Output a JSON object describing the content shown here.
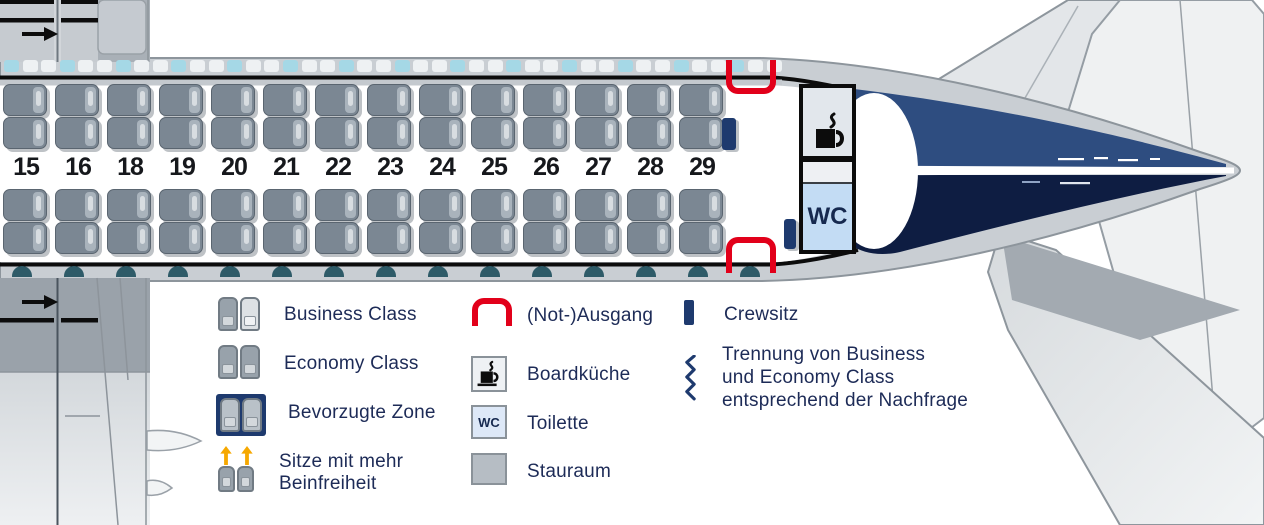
{
  "seat_map": {
    "row_numbers": [
      "15",
      "16",
      "18",
      "19",
      "20",
      "21",
      "22",
      "23",
      "24",
      "25",
      "26",
      "27",
      "28",
      "29"
    ],
    "seats_top_per_row": 2,
    "seats_bottom_per_row": 2,
    "wc_label": "WC",
    "crew_seats_count": 2,
    "exits_count": 2
  },
  "legend": {
    "business_class": "Business Class",
    "economy_class": "Economy Class",
    "bevorzugte_zone": "Bevorzugte Zone",
    "sitze_line1": "Sitze mit mehr",
    "sitze_line2": "Beinfreiheit",
    "exit": "(Not-)Ausgang",
    "galley": "Boardküche",
    "toilet": "Toilette",
    "stauraum": "Stauraum",
    "crewsitz": "Crewsitz",
    "trennung_line1": "Trennung von Business",
    "trennung_line2": "und Economy Class",
    "trennung_line3": "entsprechend der Nachfrage",
    "wc_icon_label": "WC"
  },
  "colors": {
    "exit_red": "#e2001a",
    "navy": "#1e3a6e",
    "tail_navy_upper": "#2e4d80",
    "tail_navy_lower": "#0e1d42",
    "legend_text": "#1d2b57",
    "seat_gray": "#7b8793",
    "window_cyan": "#a5d8e6",
    "window_teal": "#2e5b68",
    "legroom_arrow_orange": "#f6a800",
    "fuselage_gray": "#c9ced3"
  }
}
